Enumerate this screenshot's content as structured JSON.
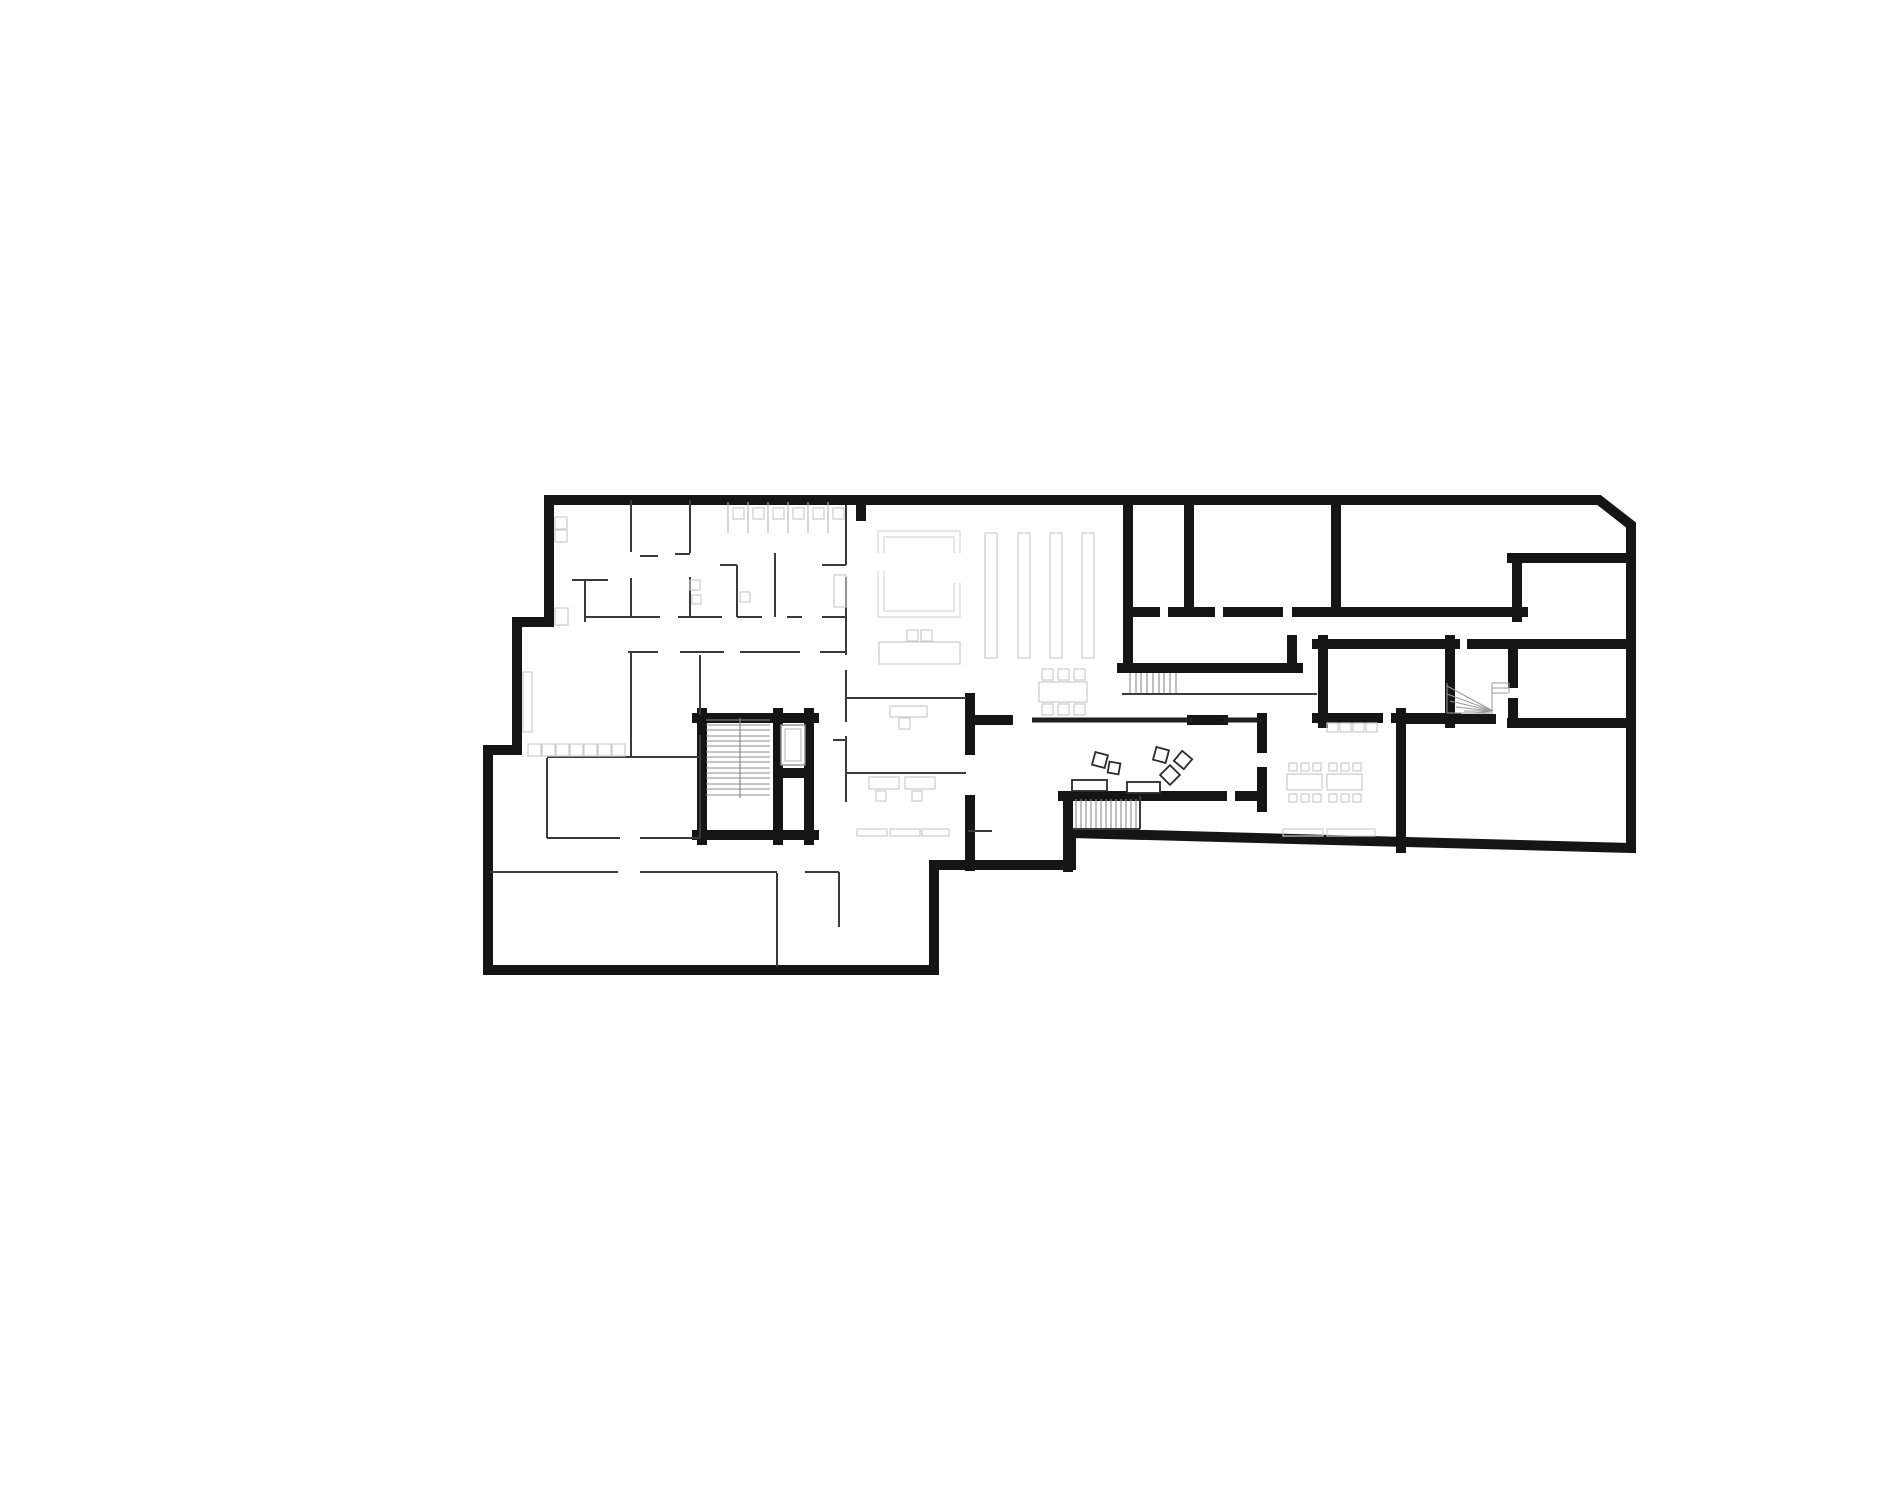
{
  "meta": {
    "kind": "architectural-floor-plan",
    "canvas": {
      "w": 1900,
      "h": 1500
    },
    "colors": {
      "bg": "#ffffff",
      "wall": "#151515",
      "wall_medium": "#1e1e1e",
      "partition": "#3a3a3a",
      "stair": "#8b8b8b",
      "stair_fine": "#9a9a9a",
      "closet_line": "#b5b5b5",
      "furniture_light": "#cccccc",
      "furniture_faint": "#dddddd",
      "furniture_dark": "#2a2a2a",
      "elevator_outer": "#8f8f8f",
      "elevator_inner": "#bdbdbd"
    }
  },
  "plan": {
    "outline": {
      "width": 10,
      "points": [
        [
          549,
          500
        ],
        [
          1599,
          500
        ],
        [
          1631,
          525
        ],
        [
          1631,
          848
        ],
        [
          1071,
          833
        ],
        [
          1071,
          865
        ],
        [
          934,
          865
        ],
        [
          934,
          970
        ],
        [
          488,
          970
        ],
        [
          488,
          750
        ],
        [
          517,
          750
        ],
        [
          517,
          622
        ],
        [
          549,
          622
        ]
      ]
    },
    "walls_thick": {
      "width": 10,
      "segments": [
        [
          861,
          500,
          861,
          516
        ],
        [
          1128,
          500,
          1128,
          668
        ],
        [
          1189,
          500,
          1189,
          612
        ],
        [
          1336,
          500,
          1336,
          612
        ],
        [
          1135,
          612,
          1155,
          612
        ],
        [
          1173,
          612,
          1210,
          612
        ],
        [
          1228,
          612,
          1278,
          612
        ],
        [
          1297,
          612,
          1523,
          612
        ],
        [
          1122,
          668,
          1298,
          668
        ],
        [
          1292,
          640,
          1292,
          668
        ],
        [
          1512,
          558,
          1631,
          558
        ],
        [
          1517,
          558,
          1517,
          617
        ],
        [
          1472,
          644,
          1629,
          644
        ],
        [
          1317,
          644,
          1455,
          644
        ],
        [
          1323,
          640,
          1323,
          723
        ],
        [
          1450,
          640,
          1450,
          723
        ],
        [
          1317,
          718,
          1378,
          718
        ],
        [
          1396,
          718,
          1456,
          718
        ],
        [
          1513,
          649,
          1513,
          683
        ],
        [
          1513,
          703,
          1513,
          719
        ],
        [
          1401,
          719,
          1491,
          719
        ],
        [
          1512,
          723,
          1629,
          723
        ],
        [
          1401,
          713,
          1401,
          848
        ],
        [
          702,
          713,
          702,
          840
        ],
        [
          778,
          713,
          778,
          840
        ],
        [
          809,
          713,
          809,
          840
        ],
        [
          697,
          718,
          786,
          718
        ],
        [
          793,
          718,
          814,
          718
        ],
        [
          697,
          835,
          814,
          835
        ],
        [
          778,
          773,
          809,
          773
        ],
        [
          975,
          720,
          1008,
          720
        ],
        [
          1192,
          720,
          1223,
          720
        ],
        [
          970,
          698,
          970,
          750
        ],
        [
          970,
          800,
          970,
          866
        ],
        [
          1063,
          796,
          1222,
          796
        ],
        [
          1240,
          796,
          1262,
          796
        ],
        [
          1262,
          718,
          1262,
          748
        ],
        [
          1262,
          772,
          1262,
          807
        ],
        [
          1068,
          796,
          1068,
          867
        ]
      ]
    },
    "walls_medium": {
      "width": 5,
      "segments": [
        [
          1032,
          720,
          1192,
          720
        ],
        [
          1223,
          720,
          1262,
          720
        ]
      ]
    },
    "walls_thin": {
      "width": 2,
      "segments": [
        [
          631,
          500,
          631,
          552
        ],
        [
          631,
          578,
          631,
          617
        ],
        [
          640,
          556,
          658,
          556
        ],
        [
          675,
          554,
          690,
          554
        ],
        [
          690,
          500,
          690,
          553
        ],
        [
          690,
          577,
          690,
          617
        ],
        [
          572,
          580,
          608,
          580
        ],
        [
          585,
          580,
          585,
          622
        ],
        [
          720,
          565,
          737,
          565
        ],
        [
          737,
          565,
          737,
          617
        ],
        [
          775,
          553,
          775,
          617
        ],
        [
          822,
          565,
          846,
          565
        ],
        [
          846,
          505,
          846,
          565
        ],
        [
          846,
          577,
          846,
          655
        ],
        [
          846,
          670,
          846,
          722
        ],
        [
          846,
          736,
          846,
          802
        ],
        [
          585,
          617,
          660,
          617
        ],
        [
          678,
          617,
          722,
          617
        ],
        [
          737,
          617,
          762,
          617
        ],
        [
          787,
          617,
          802,
          617
        ],
        [
          822,
          617,
          846,
          617
        ],
        [
          628,
          652,
          658,
          652
        ],
        [
          680,
          652,
          724,
          652
        ],
        [
          740,
          652,
          800,
          652
        ],
        [
          820,
          652,
          846,
          652
        ],
        [
          631,
          652,
          631,
          757
        ],
        [
          547,
          757,
          700,
          757
        ],
        [
          547,
          758,
          547,
          838
        ],
        [
          700,
          655,
          700,
          715
        ],
        [
          700,
          735,
          700,
          838
        ],
        [
          547,
          838,
          620,
          838
        ],
        [
          640,
          838,
          700,
          838
        ],
        [
          490,
          872,
          618,
          872
        ],
        [
          640,
          872,
          777,
          872
        ],
        [
          805,
          872,
          839,
          872
        ],
        [
          777,
          873,
          777,
          967
        ],
        [
          839,
          872,
          839,
          927
        ],
        [
          846,
          698,
          966,
          698
        ],
        [
          833,
          740,
          846,
          740
        ],
        [
          846,
          773,
          966,
          773
        ],
        [
          968,
          831,
          992,
          831
        ],
        [
          1140,
          796,
          1140,
          829
        ],
        [
          1073,
          829,
          1140,
          829
        ],
        [
          1122,
          694,
          1317,
          694
        ]
      ]
    },
    "stairs": {
      "line_sets": [
        {
          "name": "main-stair-treads",
          "dir": "h",
          "from": 706,
          "to": 770,
          "at": [
            720,
            725,
            730,
            736,
            741,
            746,
            752,
            757,
            762,
            768,
            773,
            778,
            784,
            789,
            795
          ],
          "color_key": "stair"
        },
        {
          "name": "hall-stair-treads",
          "dir": "v",
          "from": 799,
          "to": 828,
          "at": [
            1076,
            1081,
            1086,
            1091,
            1096,
            1101,
            1106,
            1111,
            1116,
            1121,
            1126,
            1131,
            1136
          ],
          "color_key": "stair"
        },
        {
          "name": "upper-stair-treads",
          "dir": "v",
          "from": 673,
          "to": 693,
          "at": [
            1130,
            1136,
            1141,
            1147,
            1153,
            1159,
            1164,
            1170,
            1176
          ],
          "color_key": "stair"
        },
        {
          "name": "closet-dividers-left",
          "dir": "v",
          "from": 502,
          "to": 533,
          "at": [
            728,
            748,
            768,
            788,
            808,
            828
          ],
          "color_key": "closet_line"
        }
      ],
      "divider": [
        740,
        718,
        740,
        798
      ],
      "fan_segments": [
        [
          1447,
          683,
          1447,
          713
        ],
        [
          1493,
          711,
          1447,
          686
        ],
        [
          1493,
          711,
          1447,
          694
        ],
        [
          1493,
          711,
          1450,
          701
        ],
        [
          1493,
          711,
          1456,
          707
        ],
        [
          1493,
          711,
          1464,
          711
        ],
        [
          1493,
          711,
          1474,
          713
        ],
        [
          1447,
          713,
          1493,
          713
        ],
        [
          1492,
          683,
          1509,
          683
        ],
        [
          1492,
          688,
          1509,
          688
        ],
        [
          1492,
          693,
          1508,
          693
        ],
        [
          1509,
          683,
          1509,
          693
        ],
        [
          1492,
          683,
          1492,
          711
        ]
      ]
    },
    "elevator": {
      "outer": [
        781,
        725,
        24,
        40
      ],
      "inner": [
        785,
        729,
        16,
        32
      ]
    },
    "furniture": {
      "light_rects": [
        [
          733,
          508,
          11,
          11
        ],
        [
          753,
          508,
          11,
          11
        ],
        [
          773,
          508,
          11,
          11
        ],
        [
          793,
          508,
          11,
          11
        ],
        [
          813,
          508,
          11,
          11
        ],
        [
          833,
          508,
          11,
          11
        ],
        [
          528,
          744,
          13,
          12
        ],
        [
          542,
          744,
          13,
          12
        ],
        [
          556,
          744,
          13,
          12
        ],
        [
          570,
          744,
          13,
          12
        ],
        [
          584,
          744,
          13,
          12
        ],
        [
          598,
          744,
          13,
          12
        ],
        [
          612,
          744,
          13,
          12
        ],
        [
          555,
          517,
          12,
          12
        ],
        [
          555,
          530,
          12,
          12
        ],
        [
          555,
          608,
          13,
          17
        ],
        [
          523,
          672,
          9,
          60
        ],
        [
          690,
          580,
          10,
          10
        ],
        [
          692,
          595,
          9,
          9
        ],
        [
          740,
          592,
          10,
          10
        ],
        [
          834,
          575,
          12,
          32
        ],
        [
          879,
          642,
          81,
          22
        ],
        [
          907,
          630,
          11,
          11
        ],
        [
          921,
          630,
          11,
          11
        ],
        [
          985,
          533,
          12,
          125
        ],
        [
          1018,
          533,
          12,
          125
        ],
        [
          1050,
          533,
          12,
          125
        ],
        [
          1082,
          533,
          12,
          125
        ],
        [
          1039,
          682,
          48,
          20
        ],
        [
          1042,
          669,
          11,
          11
        ],
        [
          1058,
          669,
          11,
          11
        ],
        [
          1074,
          669,
          11,
          11
        ],
        [
          1042,
          704,
          11,
          11
        ],
        [
          1058,
          704,
          11,
          11
        ],
        [
          1074,
          704,
          11,
          11
        ],
        [
          890,
          706,
          37,
          11
        ],
        [
          899,
          718,
          11,
          11
        ],
        [
          869,
          777,
          30,
          12
        ],
        [
          905,
          777,
          30,
          12
        ],
        [
          876,
          791,
          10,
          10
        ],
        [
          912,
          791,
          10,
          10
        ],
        [
          857,
          829,
          30,
          7
        ],
        [
          890,
          829,
          30,
          7
        ],
        [
          922,
          829,
          27,
          7
        ],
        [
          1287,
          774,
          35,
          16
        ],
        [
          1327,
          774,
          35,
          16
        ],
        [
          1289,
          763,
          8,
          8
        ],
        [
          1301,
          763,
          8,
          8
        ],
        [
          1313,
          763,
          8,
          8
        ],
        [
          1329,
          763,
          8,
          8
        ],
        [
          1341,
          763,
          8,
          8
        ],
        [
          1353,
          763,
          8,
          8
        ],
        [
          1289,
          794,
          8,
          8
        ],
        [
          1301,
          794,
          8,
          8
        ],
        [
          1313,
          794,
          8,
          8
        ],
        [
          1329,
          794,
          8,
          8
        ],
        [
          1341,
          794,
          8,
          8
        ],
        [
          1353,
          794,
          8,
          8
        ],
        [
          1327,
          723,
          11,
          9
        ],
        [
          1340,
          723,
          11,
          9
        ],
        [
          1353,
          723,
          11,
          9
        ],
        [
          1366,
          723,
          11,
          9
        ],
        [
          1283,
          829,
          40,
          7
        ],
        [
          1327,
          829,
          48,
          7
        ]
      ],
      "faint_paths": [
        "M878,553 L878,531 L960,531 L960,553",
        "M884,553 L884,537 L954,537 L954,553",
        "M878,571 L878,617 L960,617 L960,583",
        "M884,571 L884,611 L954,611 L954,583"
      ],
      "dark_rects": [
        [
          1072,
          780,
          35,
          11
        ],
        [
          1127,
          782,
          33,
          11
        ]
      ],
      "rot_squares": [
        [
          1100,
          760,
          13,
          15
        ],
        [
          1114,
          768,
          11,
          10
        ],
        [
          1161,
          755,
          13,
          15
        ],
        [
          1183,
          760,
          13,
          40
        ],
        [
          1170,
          775,
          14,
          45
        ]
      ]
    }
  }
}
